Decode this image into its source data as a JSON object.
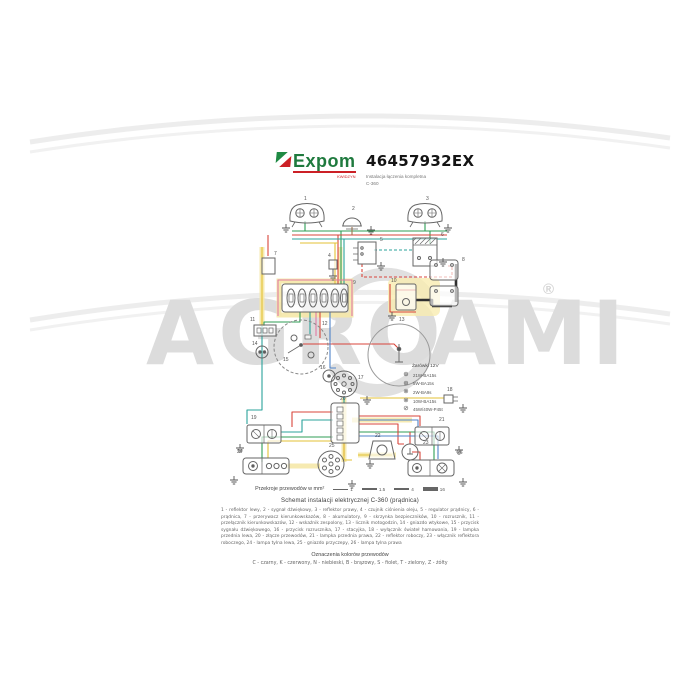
{
  "header": {
    "brand": "Expom",
    "brand_sub": "KWIDZYN",
    "part_number": "46457932EX",
    "subtitle_line1": "Instalacja łączenia kompletna",
    "subtitle_line2": "C-360"
  },
  "watermark": {
    "left": "AGRO",
    "right": "AMI",
    "registered": "®"
  },
  "diagram": {
    "bulb_legend": {
      "title": "Żarówki 12V",
      "items": [
        {
          "symbol": "⊕",
          "label": "21W-BA15s"
        },
        {
          "symbol": "⊕",
          "label": "5W-BA15s"
        },
        {
          "symbol": "⊗",
          "label": "2W-BA9s"
        },
        {
          "symbol": "⊗",
          "label": "10W-BA15s"
        },
        {
          "symbol": "⊘",
          "label": "45W/40W-P45t"
        }
      ]
    },
    "component_labels": [
      {
        "n": "1",
        "x": 304,
        "y": 200
      },
      {
        "n": "2",
        "x": 352,
        "y": 210
      },
      {
        "n": "3",
        "x": 426,
        "y": 200
      },
      {
        "n": "4",
        "x": 328,
        "y": 257
      },
      {
        "n": "5",
        "x": 380,
        "y": 241
      },
      {
        "n": "6",
        "x": 441,
        "y": 236
      },
      {
        "n": "7",
        "x": 274,
        "y": 255
      },
      {
        "n": "8",
        "x": 462,
        "y": 261
      },
      {
        "n": "9",
        "x": 353,
        "y": 284
      },
      {
        "n": "10",
        "x": 391,
        "y": 282
      },
      {
        "n": "11",
        "x": 250,
        "y": 321
      },
      {
        "n": "12",
        "x": 322,
        "y": 325
      },
      {
        "n": "13",
        "x": 399,
        "y": 321
      },
      {
        "n": "14",
        "x": 252,
        "y": 345
      },
      {
        "n": "15",
        "x": 283,
        "y": 361
      },
      {
        "n": "16",
        "x": 320,
        "y": 369
      },
      {
        "n": "17",
        "x": 358,
        "y": 379
      },
      {
        "n": "18",
        "x": 447,
        "y": 391
      },
      {
        "n": "19",
        "x": 251,
        "y": 419
      },
      {
        "n": "20",
        "x": 340,
        "y": 400
      },
      {
        "n": "21",
        "x": 439,
        "y": 421
      },
      {
        "n": "22",
        "x": 375,
        "y": 437
      },
      {
        "n": "23",
        "x": 423,
        "y": 444
      },
      {
        "n": "24",
        "x": 237,
        "y": 453
      },
      {
        "n": "25",
        "x": 329,
        "y": 447
      },
      {
        "n": "26",
        "x": 457,
        "y": 454
      }
    ]
  },
  "footer": {
    "wire_sizes": {
      "label": "Przekroje przewodów w mm²",
      "items": [
        "1",
        "1.5",
        "4",
        "16"
      ]
    },
    "title": "Schemat instalacji elektrycznej C-360 (prądnica)",
    "components_text": "1 - reflektor lewy, 2 - sygnał dźwiękowy, 3 - reflektor prawy, 4 - czujnik ciśnienia oleju, 5 - regulator prądnicy, 6 - prądnica, 7 - przerywacz kierunkowskazów, 8 - akumulatory, 9 - skrzynka bezpieczników, 10 - rozrusznik, 11 - przełącznik kierunkowskazów, 12 - wskaźnik zespolony, 13 - licznik motogodzin, 14 - gniazdo wtykowe, 15 - przycisk sygnału dźwiękowego, 16 - przycisk rozrusznika, 17 - stacyjka, 18 - wyłącznik świateł hamowania, 19 - lampka przednia lewa, 20 - złącze przewodów, 21 - lampka przednia prawa, 22 - reflektor roboczy, 23 - włącznik reflektora roboczego, 24 - lampa tylna lewa, 25 - gniazdo przyczepy, 26 - lampa tylna prawa",
    "colors_title": "Oznaczenia kolorów przewodów",
    "colors_text": "C - czarny, K - czerwony, N - niebieski, B - brązowy, S - fiolet, T - zielony, Z - żółty"
  }
}
